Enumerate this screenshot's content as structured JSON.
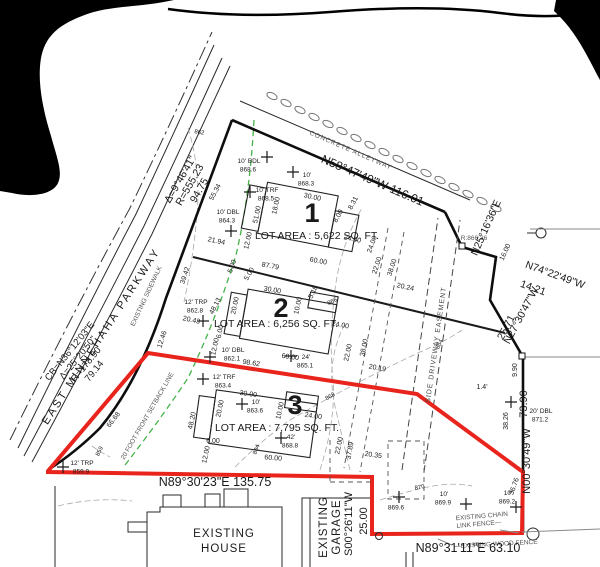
{
  "colors": {
    "boundary_red": "#e8241c",
    "setback_green": "#44b449",
    "ink": "#1a1a1a",
    "light_gray": "#8a8a8a"
  },
  "labels": {
    "road": "EAST MINNEHAHA PARKWAY",
    "sidewalk": "EXISTING SIDEWALK",
    "alley": "CONCRETE ALLEYWAY",
    "setback": "20 FOOT FRONT SETBACK LINE",
    "easement": "SIDE DRIVEWAY EASEMENT",
    "spot": "R:866.36"
  },
  "curve_upper": [
    "Δ=9°46'41\"",
    "R=555.23",
    "94.75"
  ],
  "curve_lower": [
    "CB=N36°12'03\"E",
    "Δ=25°20'50\"",
    "R=178.90",
    "79.14"
  ],
  "lots": [
    {
      "number": "1",
      "area": "LOT AREA : 5,622 SQ. FT."
    },
    {
      "number": "2",
      "area": "LOT AREA : 6,256 SQ. FT."
    },
    {
      "number": "3",
      "area": "LOT AREA : 7,795 SQ. FT."
    }
  ],
  "structures": {
    "house_line1": "EXISTING",
    "house_line2": "HOUSE",
    "garage_line1": "EXISTING",
    "garage_line2": "GARAGE",
    "chain_fence_line1": "EXISTING CHAIN",
    "chain_fence_line2": "LINK FENCE—",
    "wood_fence": "—EXISTING WOOD FENCE"
  },
  "bearings": [
    {
      "t": "N58°47'49\"W   116.01",
      "x": 371,
      "y": 184,
      "r": 23.5,
      "s": 12
    },
    {
      "t": "N25°16'36\"E",
      "x": 489,
      "y": 229,
      "r": -66,
      "s": 10.5
    },
    {
      "t": "N74°22'49\"W",
      "x": 554,
      "y": 278,
      "r": 20,
      "s": 10.5
    },
    {
      "t": "14.21",
      "x": 532,
      "y": 291,
      "r": 20,
      "s": 10.5
    },
    {
      "t": "N27°30'47\"W",
      "x": 524,
      "y": 317,
      "r": -62,
      "s": 10.5
    },
    {
      "t": "25.71",
      "x": 509,
      "y": 329,
      "r": -62,
      "s": 10.5
    },
    {
      "t": "73.90",
      "x": 527,
      "y": 404,
      "r": -90,
      "s": 11
    },
    {
      "t": "N00°30'49\"W",
      "x": 530,
      "y": 461,
      "r": -90,
      "s": 11
    },
    {
      "t": "N89°30'23\"E  135.75",
      "x": 215,
      "y": 486,
      "r": 0,
      "s": 12.5
    },
    {
      "t": "S00°26'11\"W",
      "x": 352,
      "y": 524,
      "r": -90,
      "s": 11
    },
    {
      "t": "25.00",
      "x": 367,
      "y": 521,
      "r": -90,
      "s": 11
    },
    {
      "t": "N89°31'11\"E  63.10",
      "x": 468,
      "y": 552,
      "r": 0,
      "s": 12.5
    }
  ],
  "dimensions": [
    {
      "t": "55.34",
      "x": 217,
      "y": 193,
      "r": -62
    },
    {
      "t": "21.94",
      "x": 216,
      "y": 243,
      "r": 12
    },
    {
      "t": "12.46",
      "x": 164,
      "y": 340,
      "r": -72
    },
    {
      "t": "39.42",
      "x": 187,
      "y": 276,
      "r": -72
    },
    {
      "t": "48.13",
      "x": 217,
      "y": 307,
      "r": -62
    },
    {
      "t": "20.43",
      "x": 191,
      "y": 322,
      "r": 12
    },
    {
      "t": "48.20",
      "x": 194,
      "y": 421,
      "r": -78
    },
    {
      "t": "66.68",
      "x": 115,
      "y": 421,
      "r": -52
    },
    {
      "t": "51.00",
      "x": 259,
      "y": 215,
      "r": -78
    },
    {
      "t": "18.00",
      "x": 278,
      "y": 206,
      "r": -78
    },
    {
      "t": "12.00",
      "x": 250,
      "y": 241,
      "r": -78
    },
    {
      "t": "5.00",
      "x": 234,
      "y": 267,
      "r": -70
    },
    {
      "t": "30.00",
      "x": 312,
      "y": 199,
      "r": 12
    },
    {
      "t": "8.31",
      "x": 355,
      "y": 204,
      "r": -62
    },
    {
      "t": "8.00",
      "x": 340,
      "y": 217,
      "r": -62
    },
    {
      "t": "24.00",
      "x": 352,
      "y": 241,
      "r": 12
    },
    {
      "t": "24.00",
      "x": 374,
      "y": 245,
      "r": -70
    },
    {
      "t": "60.00",
      "x": 318,
      "y": 263,
      "r": 11
    },
    {
      "t": "87.79",
      "x": 270,
      "y": 268,
      "r": 11
    },
    {
      "t": "22.00",
      "x": 379,
      "y": 266,
      "r": -72
    },
    {
      "t": "38.00",
      "x": 394,
      "y": 268,
      "r": -72
    },
    {
      "t": "20.24",
      "x": 405,
      "y": 289,
      "r": 12
    },
    {
      "t": "16.00",
      "x": 507,
      "y": 253,
      "r": -65
    },
    {
      "t": "30.00",
      "x": 272,
      "y": 292,
      "r": 10
    },
    {
      "t": "5.00",
      "x": 251,
      "y": 275,
      "r": -60
    },
    {
      "t": "20.00",
      "x": 237,
      "y": 306,
      "r": -78
    },
    {
      "t": "5.18",
      "x": 315,
      "y": 293,
      "r": -65
    },
    {
      "t": "10.00",
      "x": 300,
      "y": 306,
      "r": -78
    },
    {
      "t": "24.00",
      "x": 340,
      "y": 327,
      "r": 10
    },
    {
      "t": "60.00",
      "x": 290,
      "y": 359,
      "r": 8
    },
    {
      "t": "98.62",
      "x": 251,
      "y": 365,
      "r": 9
    },
    {
      "t": "6.00",
      "x": 222,
      "y": 332,
      "r": -78
    },
    {
      "t": "12.00",
      "x": 217,
      "y": 347,
      "r": -78
    },
    {
      "t": "22.00",
      "x": 350,
      "y": 353,
      "r": -78
    },
    {
      "t": "38.00",
      "x": 366,
      "y": 348,
      "r": -78
    },
    {
      "t": "20.19",
      "x": 377,
      "y": 370,
      "r": 10
    },
    {
      "t": "30.00",
      "x": 248,
      "y": 396,
      "r": 8
    },
    {
      "t": "20.00",
      "x": 222,
      "y": 409,
      "r": -78
    },
    {
      "t": "10.00",
      "x": 282,
      "y": 411,
      "r": -78
    },
    {
      "t": "24.00",
      "x": 313,
      "y": 418,
      "r": 8
    },
    {
      "t": "22.00",
      "x": 341,
      "y": 446,
      "r": -78
    },
    {
      "t": "37.89",
      "x": 352,
      "y": 451,
      "r": -80
    },
    {
      "t": "60.00",
      "x": 273,
      "y": 460,
      "r": 5
    },
    {
      "t": "6.00",
      "x": 213,
      "y": 443,
      "r": 0
    },
    {
      "t": "12.00",
      "x": 208,
      "y": 455,
      "r": -78
    },
    {
      "t": "20.35",
      "x": 373,
      "y": 457,
      "r": 8
    },
    {
      "t": "9.90",
      "x": 517,
      "y": 370,
      "r": -90
    },
    {
      "t": "38.26",
      "x": 508,
      "y": 421,
      "r": -90
    },
    {
      "t": "36.76",
      "x": 516,
      "y": 487,
      "r": -70
    },
    {
      "t": "1.4'",
      "x": 482,
      "y": 389,
      "r": 0
    }
  ],
  "trees": [
    {
      "size": "10' BDL",
      "elev": "868.6",
      "sx": 267,
      "sy": 157,
      "tx": 249,
      "ty": 163
    },
    {
      "size": "10'",
      "elev": "868.3",
      "sx": 293,
      "sy": 172,
      "tx": 307,
      "ty": 177
    },
    {
      "size": "10' TRF",
      "elev": "868.5",
      "sx": 250,
      "sy": 192,
      "tx": 267,
      "ty": 192
    },
    {
      "size": "10' DBL",
      "elev": "864.3",
      "sx": 231,
      "sy": 231,
      "tx": 228,
      "ty": 214
    },
    {
      "size": "12' TRP",
      "elev": "862.8",
      "sx": 203,
      "sy": 321,
      "tx": 196,
      "ty": 304
    },
    {
      "size": "10' DBL",
      "elev": "862.1",
      "sx": 210,
      "sy": 357,
      "tx": 233,
      "ty": 352
    },
    {
      "size": "24'",
      "elev": "865.1",
      "sx": 291,
      "sy": 356,
      "tx": 306,
      "ty": 359
    },
    {
      "size": "12' TRF",
      "elev": "863.4",
      "sx": 203,
      "sy": 379,
      "tx": 224,
      "ty": 379
    },
    {
      "size": "10'",
      "elev": "863.6",
      "sx": 242,
      "sy": 404,
      "tx": 256,
      "ty": 404
    },
    {
      "size": "42'",
      "elev": "868.8",
      "sx": 281,
      "sy": 438,
      "tx": 291,
      "ty": 439
    },
    {
      "size": "12' TRP",
      "elev": "859.9",
      "sx": 63,
      "sy": 467,
      "tx": 82,
      "ty": 465
    },
    {
      "size": "20' DBL",
      "elev": "871.2",
      "sx": 511,
      "sy": 402,
      "tx": 541,
      "ty": 413
    },
    {
      "size": "10'",
      "elev": "869.9",
      "sx": 466,
      "sy": 504,
      "tx": 444,
      "ty": 496
    },
    {
      "size": "",
      "elev": "869.6",
      "sx": 399,
      "sy": 497,
      "tx": 397,
      "ty": 501
    },
    {
      "size": "10'",
      "elev": "869.2",
      "sx": 516,
      "sy": 507,
      "tx": 508,
      "ty": 495
    }
  ],
  "contour_labels": [
    {
      "t": "862",
      "x": 199,
      "y": 134,
      "r": 10
    },
    {
      "t": "859",
      "x": 101,
      "y": 452,
      "r": -65
    },
    {
      "t": "864",
      "x": 258,
      "y": 450,
      "r": -70
    },
    {
      "t": "864",
      "x": 441,
      "y": 345,
      "r": -65
    },
    {
      "t": "866",
      "x": 333,
      "y": 303,
      "r": -25
    },
    {
      "t": "868",
      "x": 331,
      "y": 398,
      "r": -30
    },
    {
      "t": "870",
      "x": 420,
      "y": 489,
      "r": -12
    }
  ]
}
